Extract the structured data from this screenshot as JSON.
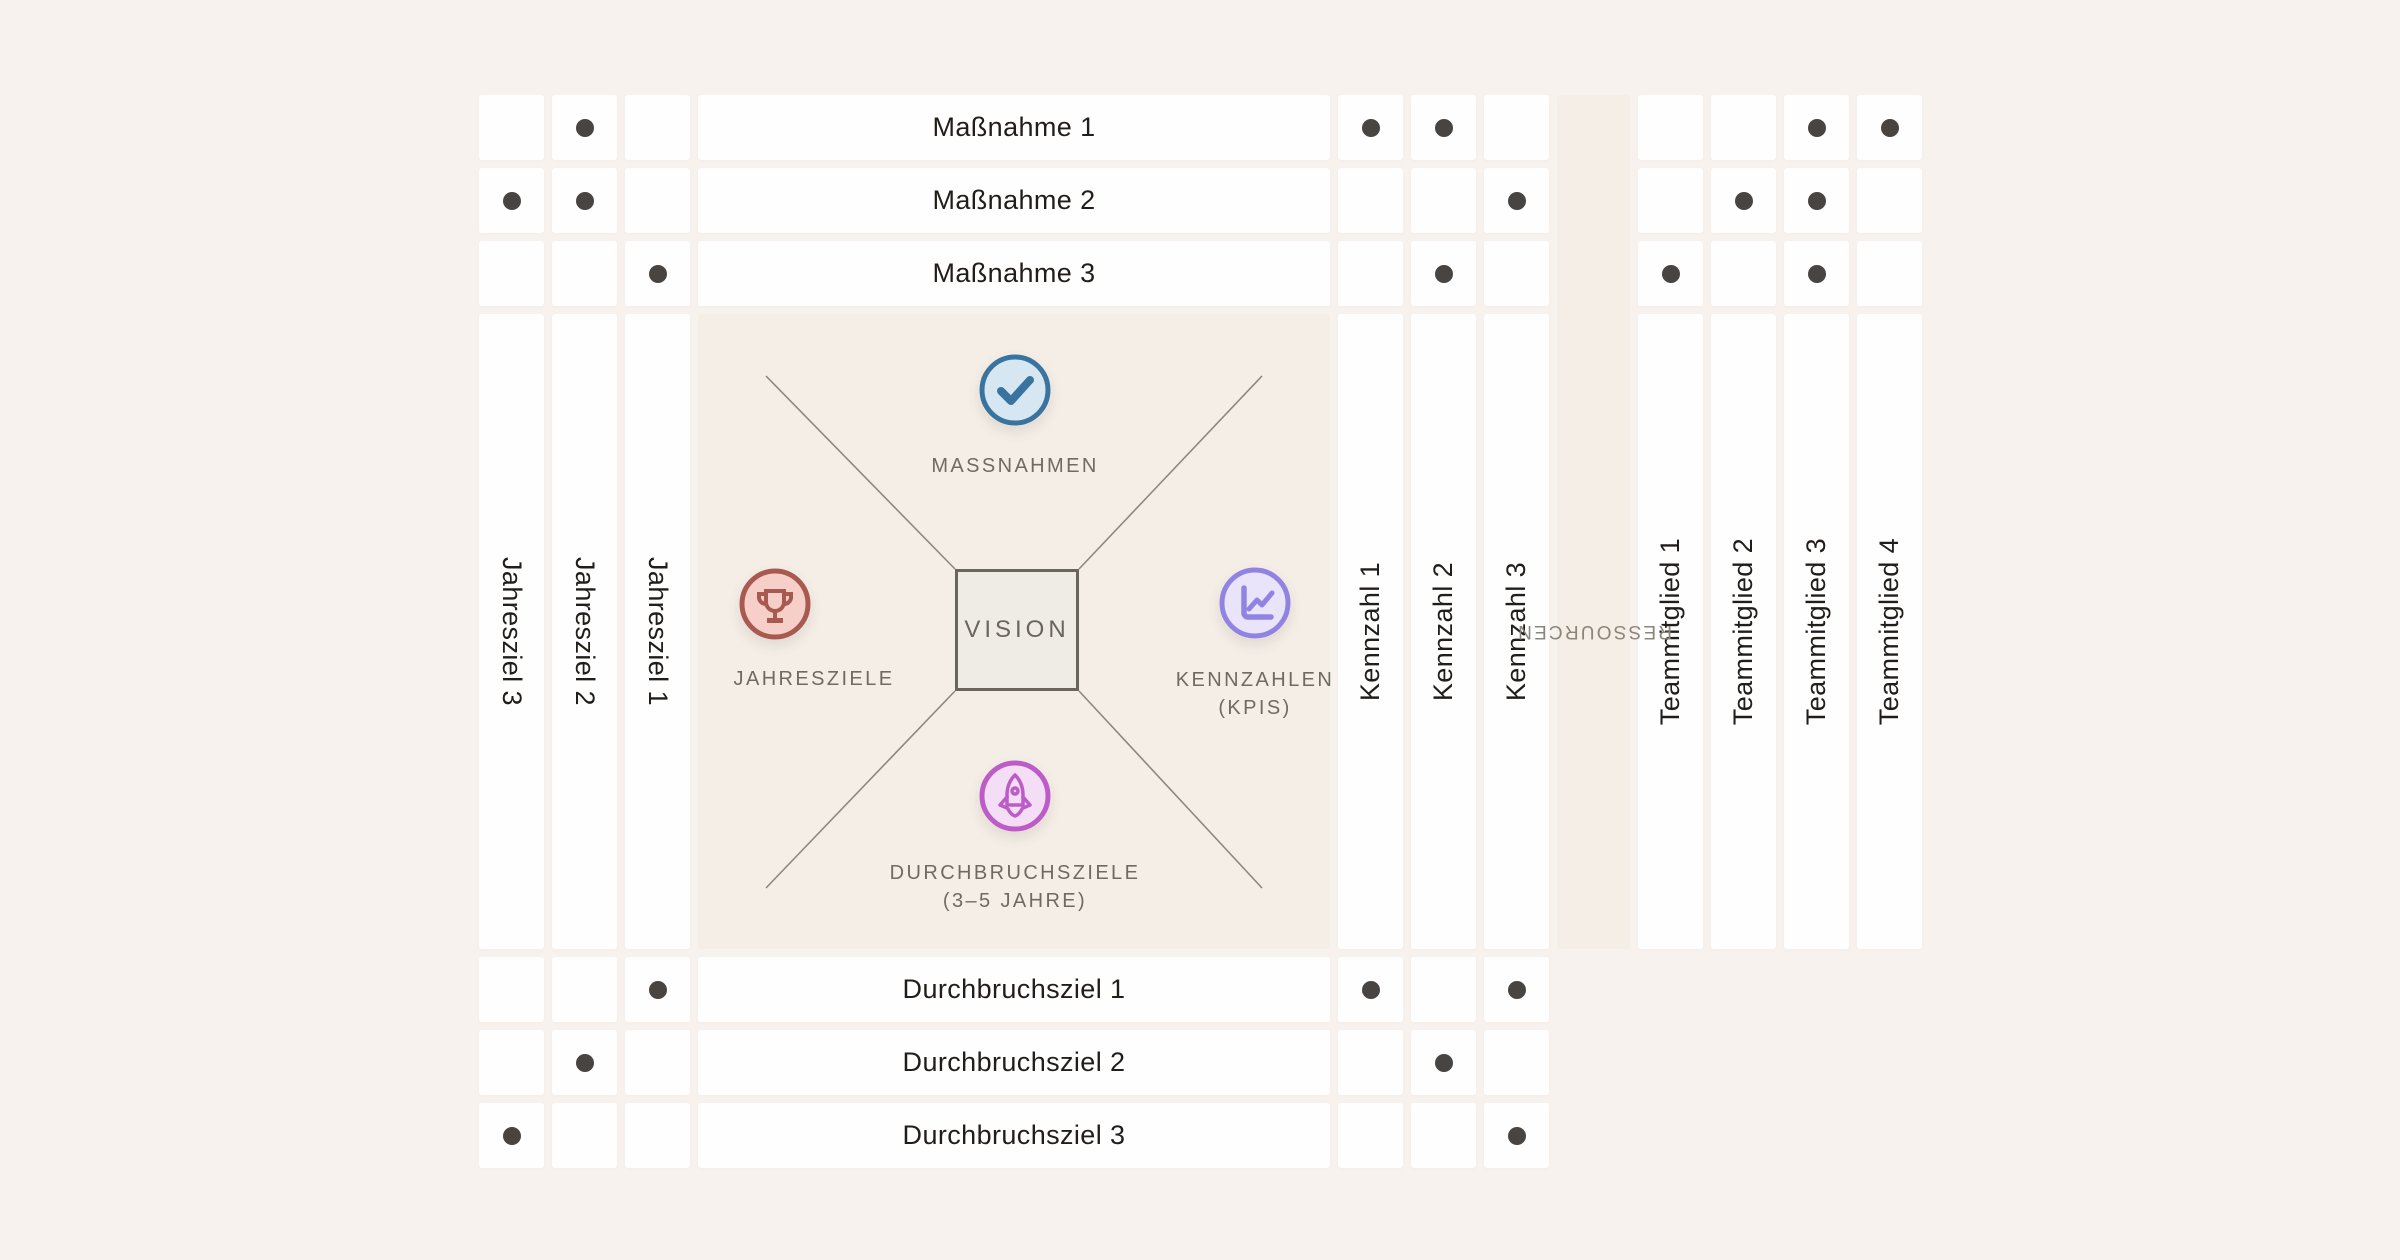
{
  "diagram_title": "Hoshin Kanri X-Matrix",
  "colors": {
    "page_bg": "#f8f2ee",
    "panel_bg": "#f4eee7",
    "cell_bg": "#fffefe",
    "dot": "#474442",
    "line": "#8d887d",
    "vision_fill": "#efece5",
    "vision_border": "#6a665c",
    "label_dark": "#211e1a",
    "label_gray": "#6f6a62",
    "resource_gray": "#8b857a",
    "check_fill": "#d6e7f2",
    "check_stroke": "#38749f",
    "trophy_fill": "#f6cfc9",
    "trophy_stroke": "#a85a50",
    "chart_fill": "#e9e4fa",
    "chart_stroke": "#9183e2",
    "rocket_fill": "#f4def5",
    "rocket_stroke": "#bc5dc7"
  },
  "matrix": {
    "rows_top": [
      "Maßnahme 1",
      "Maßnahme 2",
      "Maßnahme 3"
    ],
    "rows_bottom": [
      "Durchbruchsziel 1",
      "Durchbruchsziel 2",
      "Durchbruchsziel 3"
    ],
    "columns_left": [
      "Jahresziel 3",
      "Jahresziel 2",
      "Jahresziel 1"
    ],
    "columns_right": [
      "Kennzahl 1",
      "Kennzahl 2",
      "Kennzahl 3"
    ],
    "columns_team": [
      "Teammitglied 1",
      "Teammitglied 2",
      "Teammitglied 3",
      "Teammitglied 4"
    ],
    "resources_label": "RESSOURCEN",
    "correlations": {
      "top_left": [
        [
          0,
          1,
          0
        ],
        [
          1,
          1,
          0
        ],
        [
          0,
          0,
          1
        ]
      ],
      "top_right": [
        [
          1,
          1,
          0
        ],
        [
          0,
          0,
          1
        ],
        [
          0,
          1,
          0
        ]
      ],
      "top_team": [
        [
          0,
          0,
          1,
          1
        ],
        [
          0,
          1,
          1,
          0
        ],
        [
          1,
          0,
          1,
          0
        ]
      ],
      "bottom_left": [
        [
          0,
          0,
          1
        ],
        [
          0,
          1,
          0
        ],
        [
          1,
          0,
          0
        ]
      ],
      "bottom_right": [
        [
          1,
          0,
          1
        ],
        [
          0,
          1,
          0
        ],
        [
          0,
          0,
          1
        ]
      ]
    }
  },
  "center": {
    "vision": "VISION",
    "top": {
      "icon": "check-icon",
      "label": "MASSNAHMEN"
    },
    "left": {
      "icon": "trophy-icon",
      "label": "JAHRESZIELE"
    },
    "right": {
      "icon": "chart-icon",
      "label": "KENNZAHLEN",
      "sublabel": "(KPIS)"
    },
    "bottom": {
      "icon": "rocket-icon",
      "label": "DURCHBRUCHSZIELE",
      "sublabel": "(3–5 JAHRE)"
    }
  }
}
